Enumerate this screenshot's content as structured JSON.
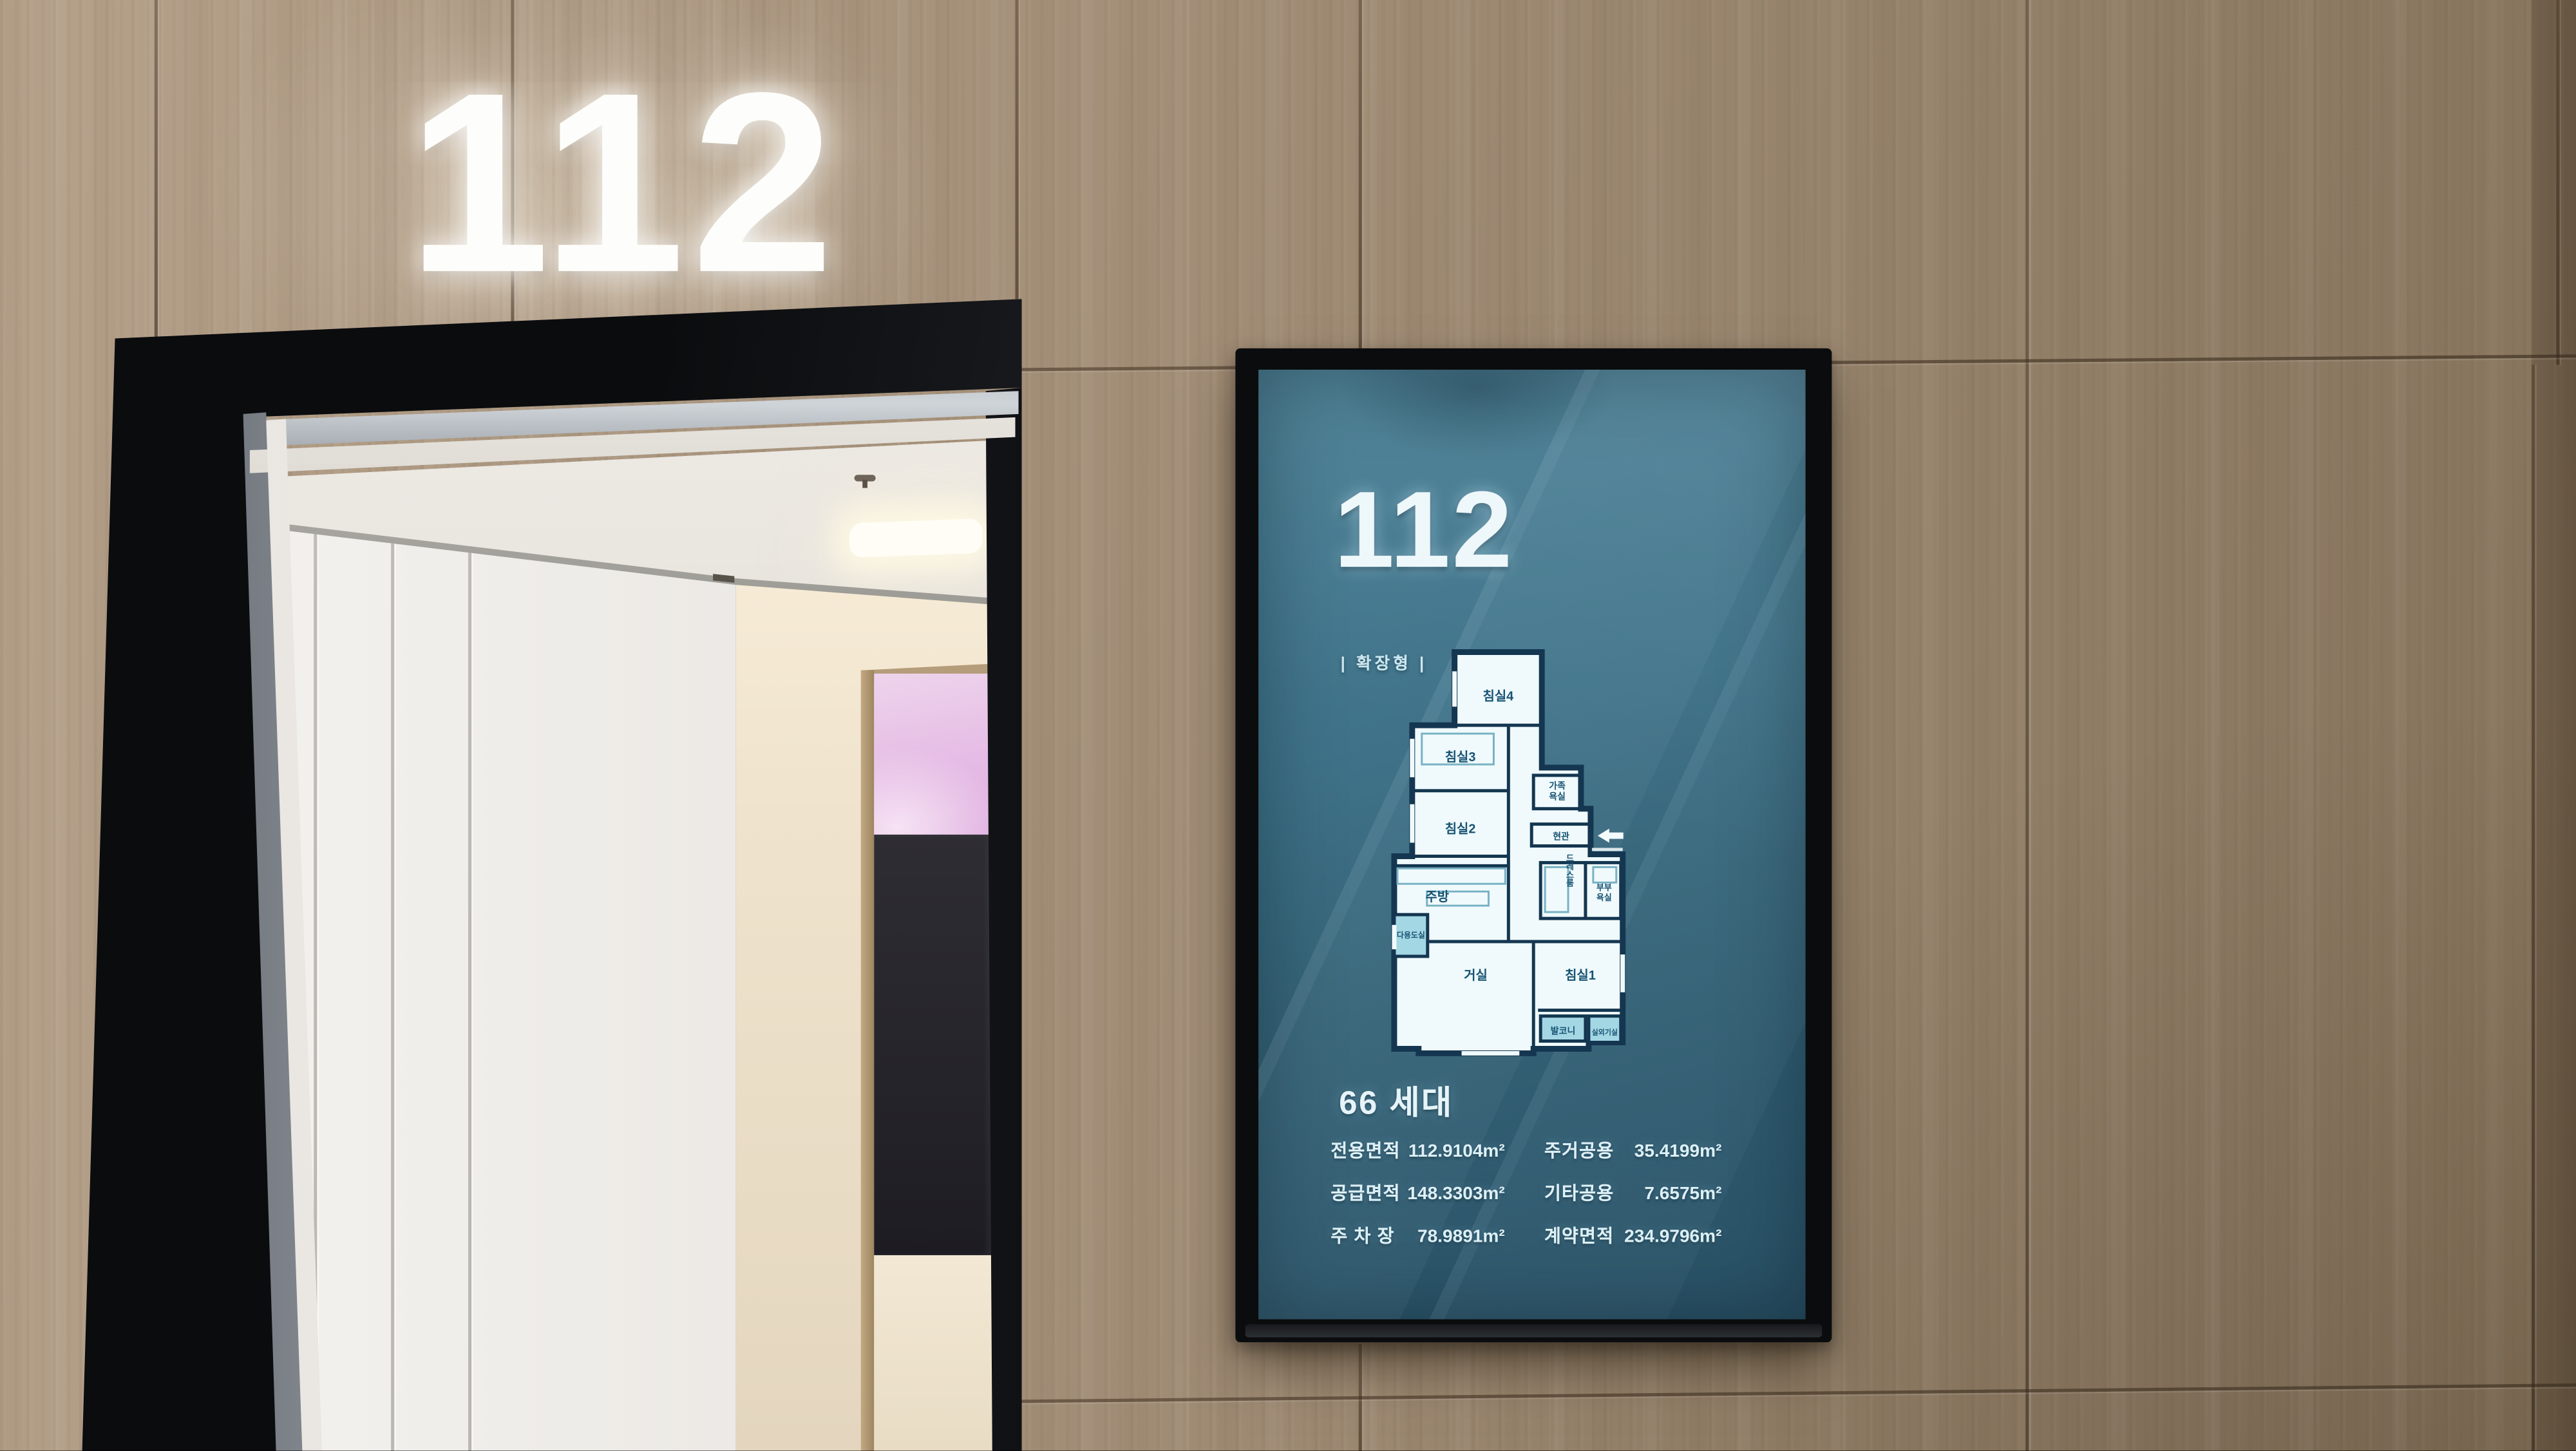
{
  "scene": {
    "sign_number": "112",
    "display": {
      "unit_number": "112",
      "type_tag": "| 확장형 |",
      "household_count": "66 세대",
      "stats_left": [
        {
          "label": "전용면적",
          "value": "112.9104m²"
        },
        {
          "label": "공급면적",
          "value": "148.3303m²"
        },
        {
          "label": "주 차 장",
          "value": "78.9891m²"
        }
      ],
      "stats_right": [
        {
          "label": "주거공용",
          "value": "35.4199m²"
        },
        {
          "label": "기타공용",
          "value": "7.6575m²"
        },
        {
          "label": "계약면적",
          "value": "234.9796m²"
        }
      ],
      "floorplan": {
        "labels": {
          "bed4": "침실4",
          "bed3": "침실3",
          "bed2": "침실2",
          "family_bath_line1": "가족",
          "family_bath_line2": "욕실",
          "entrance": "현관",
          "kitchen": "주방",
          "utility": "다용도실",
          "living": "거실",
          "dressroom": "드레스룸",
          "master_bath_line1": "부부",
          "master_bath_line2": "욕실",
          "bed1": "침실1",
          "balcony": "발코니",
          "ac_unit_room": "실외기실"
        }
      }
    },
    "colors": {
      "wall_tan": "#a8947d",
      "door_frame_black": "#0b0c0e",
      "screen_teal_top": "#4c8095",
      "screen_teal_bottom": "#2a5165",
      "screen_text": "#ddf0f6",
      "plan_wall_navy": "#143650",
      "plan_room_fill": "#f0fafc",
      "plan_accent_cyan": "#a4d7e4",
      "interior_pink_glow": "#e5bce5"
    }
  }
}
